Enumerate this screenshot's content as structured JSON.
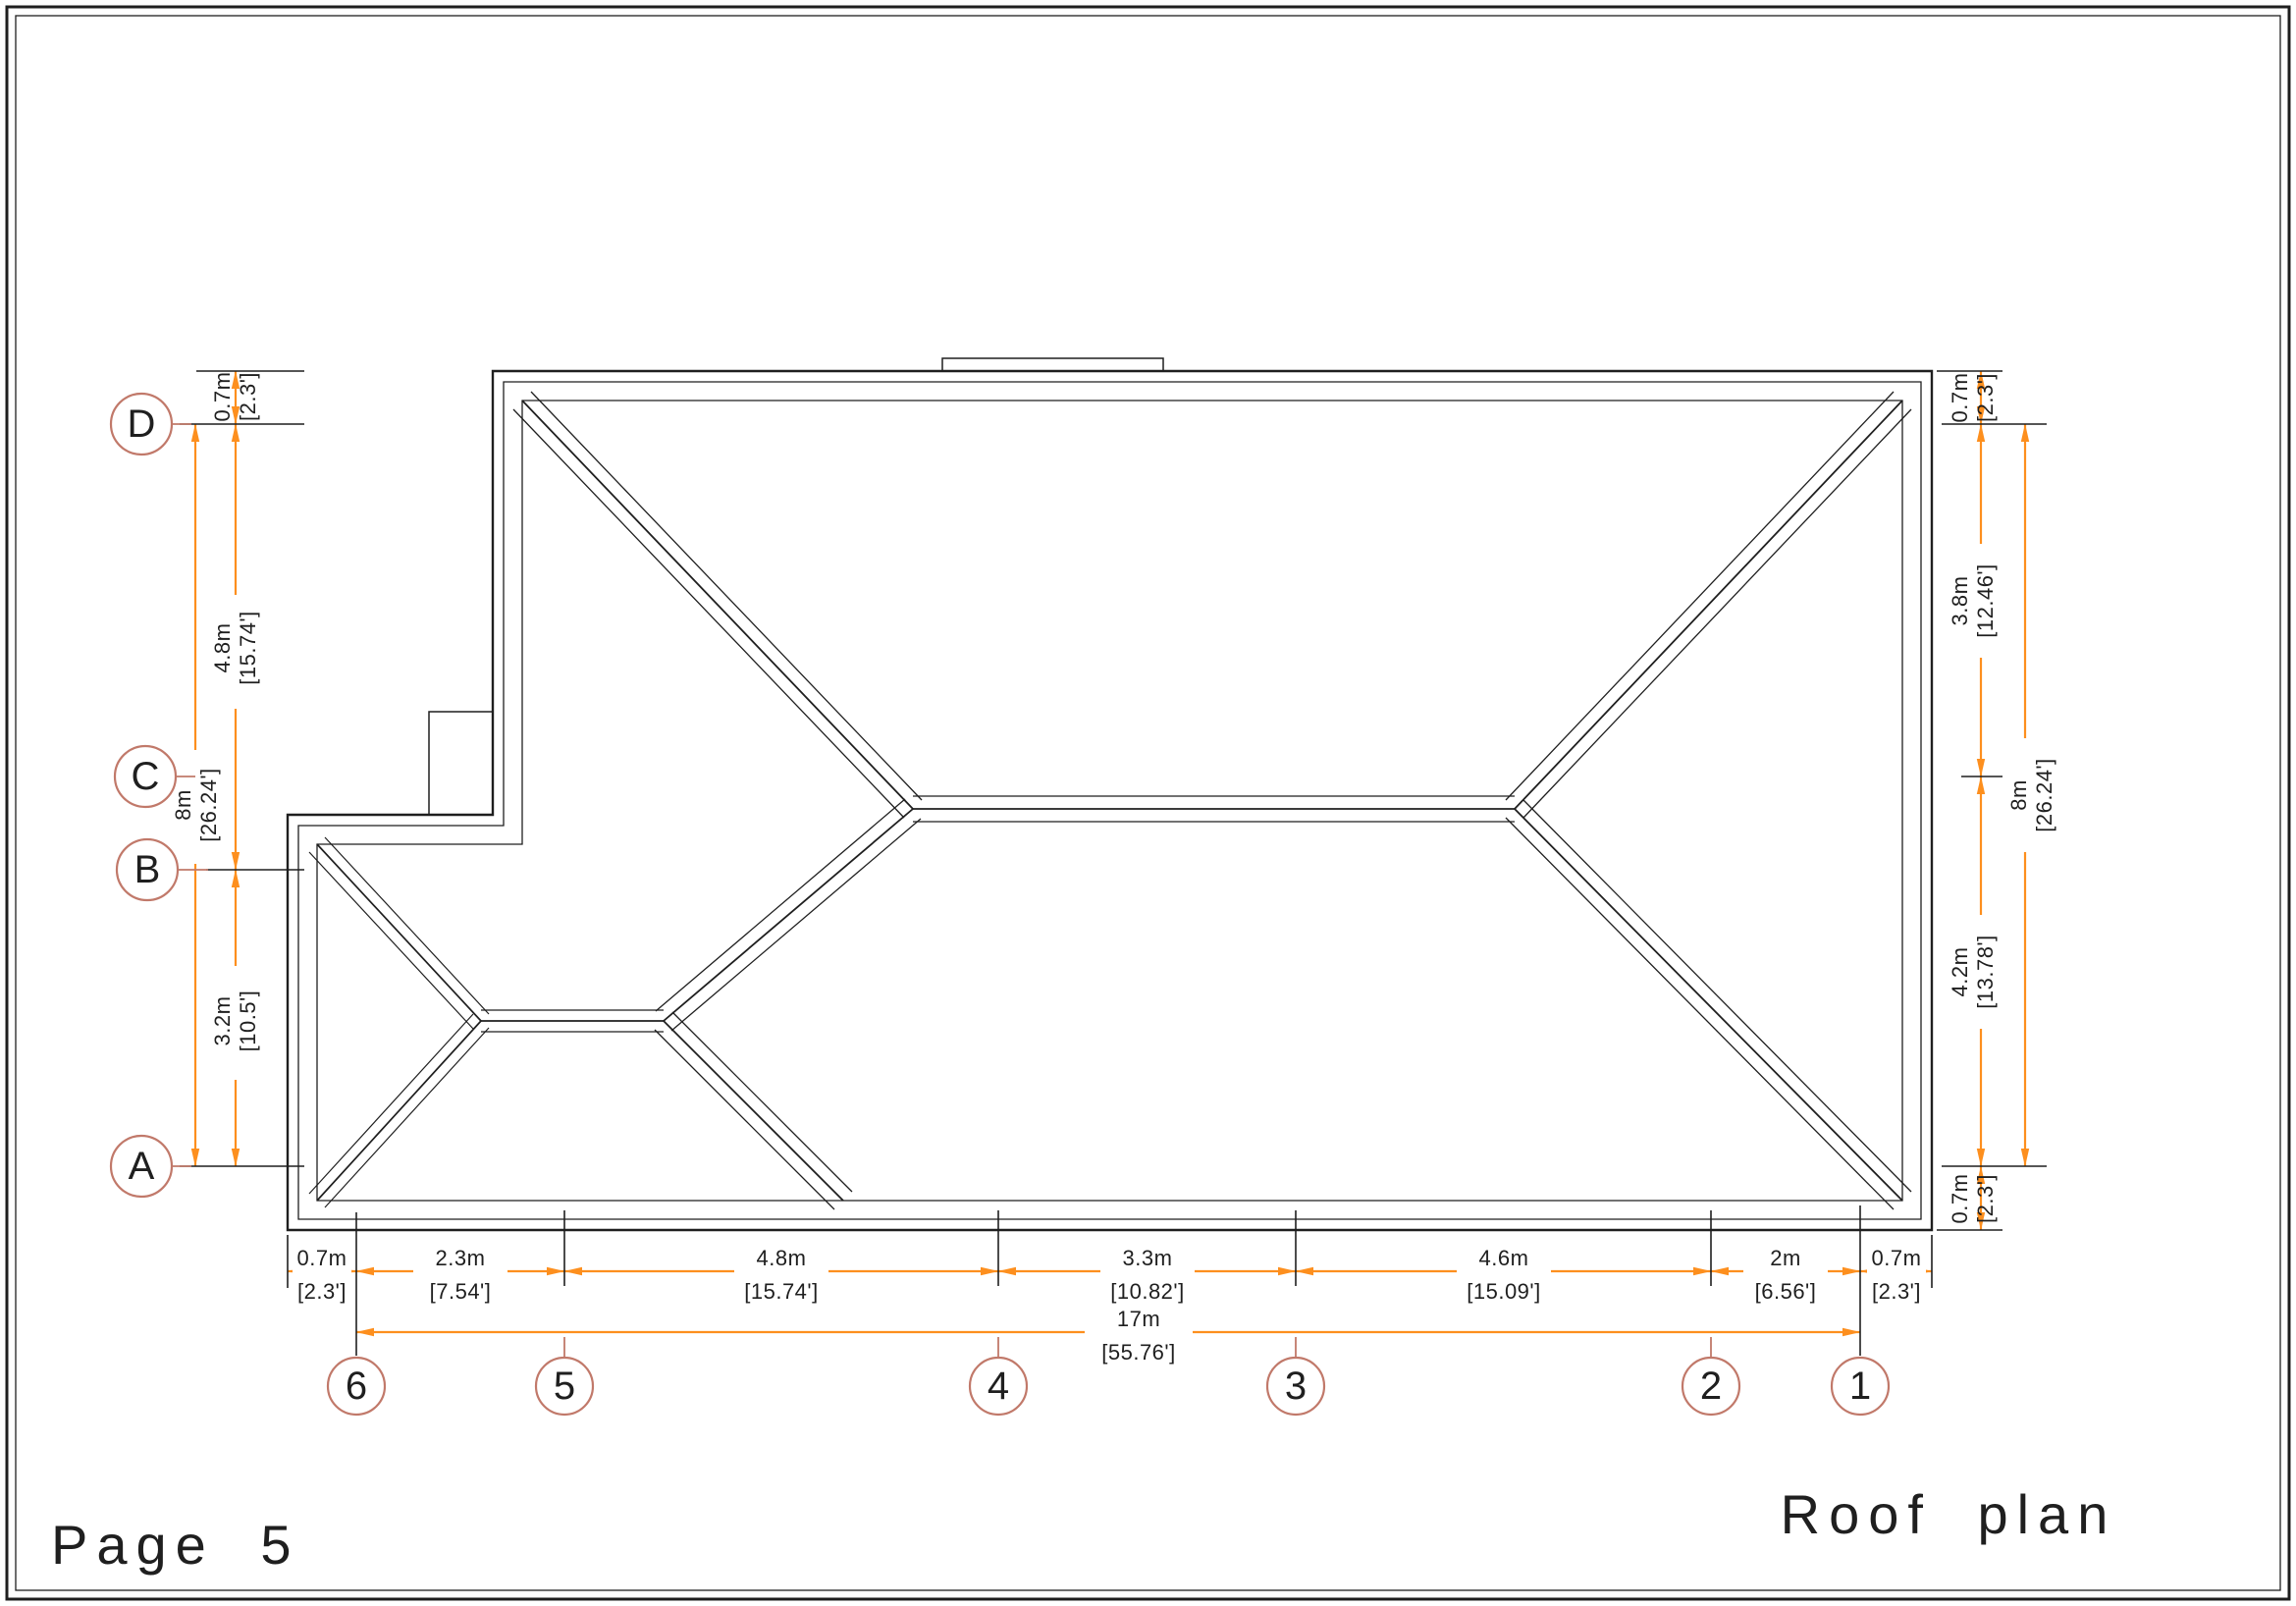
{
  "page": {
    "label": "Page 5",
    "title": "Roof plan"
  },
  "colors": {
    "dimension_line": "#fd8f1e",
    "grid_bubble": "#c1796a",
    "drawing_line": "#1f1f1f",
    "paper": "#ffffff"
  },
  "grid_rows": [
    {
      "label": "D"
    },
    {
      "label": "C"
    },
    {
      "label": "B"
    },
    {
      "label": "A"
    }
  ],
  "grid_cols": [
    {
      "label": "6"
    },
    {
      "label": "5"
    },
    {
      "label": "4"
    },
    {
      "label": "3"
    },
    {
      "label": "2"
    },
    {
      "label": "1"
    }
  ],
  "dims": {
    "left_chain": [
      {
        "m": "0.7m",
        "ft": "[2.3']"
      },
      {
        "m": "4.8m",
        "ft": "[15.74']"
      },
      {
        "m": "3.2m",
        "ft": "[10.5']"
      }
    ],
    "left_overall": {
      "m": "8m",
      "ft": "[26.24']"
    },
    "right_chain": [
      {
        "m": "0.7m",
        "ft": "[2.3']"
      },
      {
        "m": "3.8m",
        "ft": "[12.46']"
      },
      {
        "m": "4.2m",
        "ft": "[13.78']"
      },
      {
        "m": "0.7m",
        "ft": "[2.3']"
      }
    ],
    "right_overall": {
      "m": "8m",
      "ft": "[26.24']"
    },
    "bottom_chain": [
      {
        "m": "0.7m",
        "ft": "[2.3']"
      },
      {
        "m": "2.3m",
        "ft": "[7.54']"
      },
      {
        "m": "4.8m",
        "ft": "[15.74']"
      },
      {
        "m": "3.3m",
        "ft": "[10.82']"
      },
      {
        "m": "4.6m",
        "ft": "[15.09']"
      },
      {
        "m": "2m",
        "ft": "[6.56']"
      },
      {
        "m": "0.7m",
        "ft": "[2.3']"
      }
    ],
    "bottom_overall": {
      "m": "17m",
      "ft": "[55.76']"
    }
  }
}
